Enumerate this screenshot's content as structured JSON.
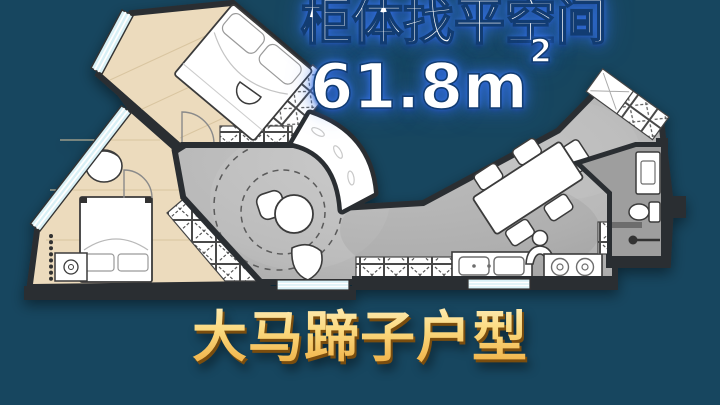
{
  "overlay": {
    "headline": "柜体找平空间",
    "area_value": "61.8m",
    "area_superscript": "2",
    "footer_title": "大马蹄子户型"
  },
  "colors": {
    "background": "#17465f",
    "headline_fill": "#ffffff",
    "headline_glow": "#3573eb",
    "headline_outline": "#123c72",
    "footer_gold": "#f6c963",
    "wall": "#2c2f33",
    "wood_floor": "#ecdbbd",
    "concrete_floor": "#bcbcbc",
    "bathroom_floor": "#9e9e9e",
    "window": "#d8f0f6",
    "cabinet_fill": "#ffffff"
  },
  "floorplan": {
    "rooms": [
      "bedroom-1",
      "bedroom-2",
      "living-area",
      "dining-area",
      "kitchen",
      "bathroom",
      "balcony-bay"
    ]
  }
}
